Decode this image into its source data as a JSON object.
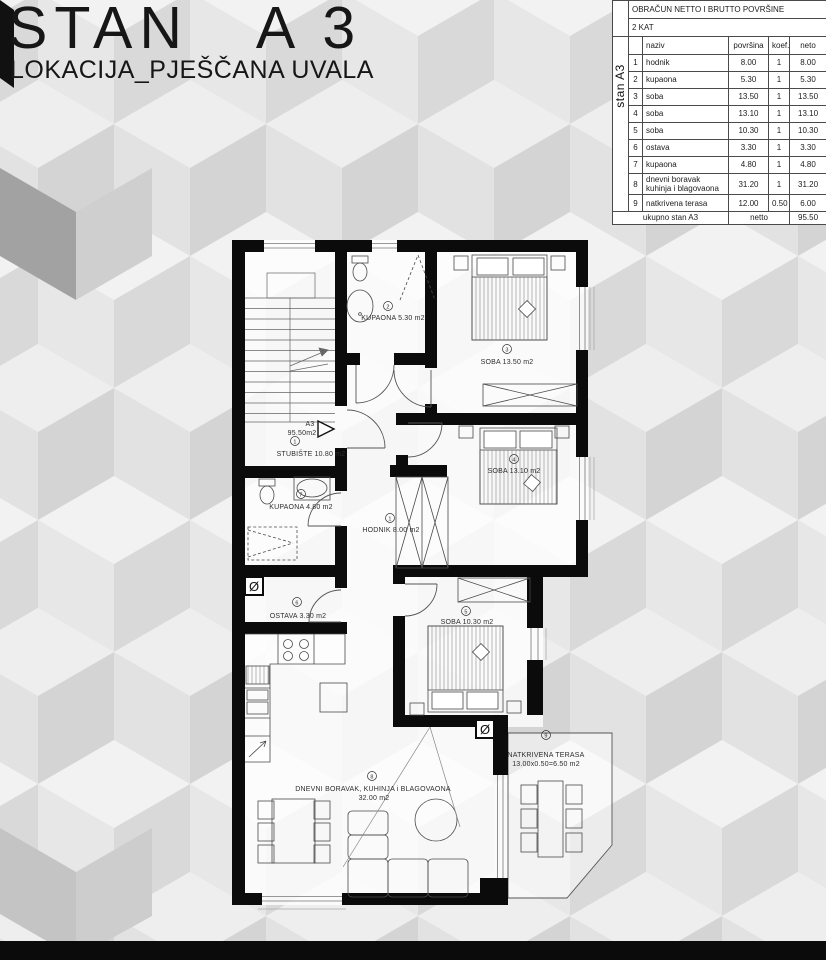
{
  "title": "STAN   A 3",
  "subtitle": "LOKACIJA_PJEŠČANA UVALA",
  "table": {
    "side_label": "stan A3",
    "header1": "OBRAČUN NETTO I BRUTTO POVRŠINE",
    "header2": "2 KAT",
    "columns": {
      "naziv": "naziv",
      "povrsina": "površina",
      "koef": "koef.",
      "neto": "neto"
    },
    "rows": [
      {
        "num": "1",
        "naziv": "hodnik",
        "povrsina": "8.00",
        "koef": "1",
        "neto": "8.00"
      },
      {
        "num": "2",
        "naziv": "kupaona",
        "povrsina": "5.30",
        "koef": "1",
        "neto": "5.30"
      },
      {
        "num": "3",
        "naziv": "soba",
        "povrsina": "13.50",
        "koef": "1",
        "neto": "13.50"
      },
      {
        "num": "4",
        "naziv": "soba",
        "povrsina": "13.10",
        "koef": "1",
        "neto": "13.10"
      },
      {
        "num": "5",
        "naziv": "soba",
        "povrsina": "10.30",
        "koef": "1",
        "neto": "10.30"
      },
      {
        "num": "6",
        "naziv": "ostava",
        "povrsina": "3.30",
        "koef": "1",
        "neto": "3.30"
      },
      {
        "num": "7",
        "naziv": "kupaona",
        "povrsina": "4.80",
        "koef": "1",
        "neto": "4.80"
      },
      {
        "num": "8",
        "naziv": "dnevni boravak\nkuhinja i blagovaona",
        "povrsina": "31.20",
        "koef": "1",
        "neto": "31.20"
      },
      {
        "num": "9",
        "naziv": "natkrivena terasa",
        "povrsina": "12.00",
        "koef": "0.50",
        "neto": "6.00"
      }
    ],
    "footer": {
      "label": "ukupno stan A3",
      "mid": "netto",
      "value": "95.50"
    }
  },
  "plan": {
    "unit": {
      "name": "A3",
      "area": "95.50m2"
    },
    "rooms": [
      {
        "num": "1",
        "label": "STUBIŠTE 10.80 m2"
      },
      {
        "num": "2",
        "label": "KUPAONA 5.30 m2"
      },
      {
        "num": "3",
        "label": "SOBA 13.50 m2"
      },
      {
        "num": "4",
        "label": "SOBA 13.10 m2"
      },
      {
        "num": "1",
        "label": "HODNIK 8.00 m2"
      },
      {
        "num": "7",
        "label": "KUPAONA 4.80 m2"
      },
      {
        "num": "6",
        "label": "OSTAVA 3.30 m2"
      },
      {
        "num": "5",
        "label": "SOBA 10.30 m2"
      },
      {
        "num": "8",
        "label": "DNEVNI BORAVAK, KUHINJA i BLAGOVAONA",
        "label2": "32.00 m2"
      },
      {
        "num": "9",
        "label": "NATKRIVENA TERASA",
        "label2": "13.00x0.50=6.50 m2"
      }
    ],
    "shaft_symbol": "Ø"
  },
  "colors": {
    "wall": "#0b0b0b",
    "cube_top": "#f2f2f2",
    "cube_left": "#e7e7e7",
    "cube_right": "#d9d9d9",
    "accent_dark": "#a2a2a2"
  }
}
